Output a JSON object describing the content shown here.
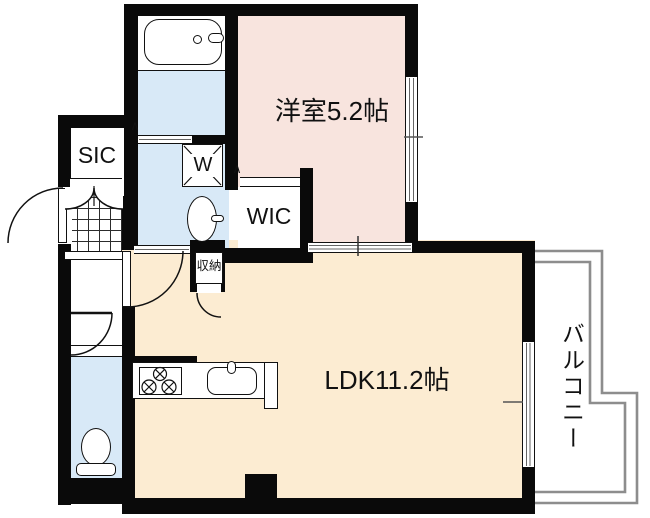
{
  "plan": {
    "rooms": {
      "western_room": "洋室5.2帖",
      "ldk": "LDK11.2帖",
      "balcony": "バルコニー",
      "sic": "SIC",
      "wic": "WIC",
      "washer_space": "W",
      "storage": "収納"
    },
    "marks": {
      "door_swing": "∧"
    },
    "colors": {
      "wall": "#0a0a0a",
      "western_room_floor": "#f8e4de",
      "ldk_floor": "#fcecd2",
      "wet_area_floor": "#d8e9f7",
      "balcony_line": "#8d8d8d"
    }
  }
}
